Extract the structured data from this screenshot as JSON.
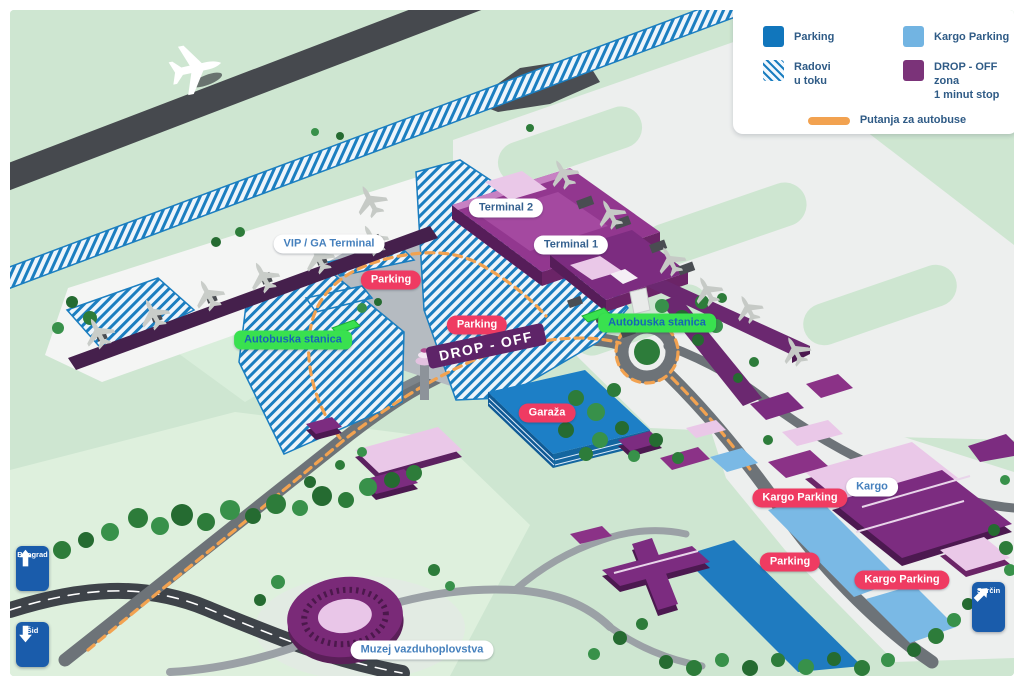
{
  "legend": {
    "items": [
      {
        "label": "Parking",
        "color": "#1176bc",
        "swatch": "solid"
      },
      {
        "label": "Kargo Parking",
        "color": "#72b4e2",
        "swatch": "solid"
      },
      {
        "label": "Radovi\nu toku",
        "color": "#1b7ec0",
        "swatch": "hatch"
      },
      {
        "label": "DROP - OFF zona\n1 minut stop",
        "color": "#7b3379",
        "swatch": "solid"
      }
    ],
    "bus_route": {
      "label": "Putanja za autobuse",
      "color": "#f2a250"
    }
  },
  "badges": {
    "vip_ga_terminal": "VIP / GA Terminal",
    "terminal_2": "Terminal 2",
    "terminal_1": "Terminal 1",
    "parking_west": "Parking",
    "parking_central": "Parking",
    "bus_stop_west": "Autobuska stanica",
    "bus_stop_east": "Autobuska stanica",
    "drop_off": "DROP - OFF",
    "garage": "Garaža",
    "kargo_parking_north": "Kargo Parking",
    "kargo": "Kargo",
    "parking_south": "Parking",
    "kargo_parking_south": "Kargo Parking",
    "museum": "Muzej vazduhoplovstva"
  },
  "road_signs": {
    "beograd": {
      "label": "Beograd",
      "direction": "up"
    },
    "sid": {
      "label": "Šid",
      "direction": "down"
    },
    "surcin": {
      "label": "Surčin",
      "direction": "up-right"
    }
  }
}
